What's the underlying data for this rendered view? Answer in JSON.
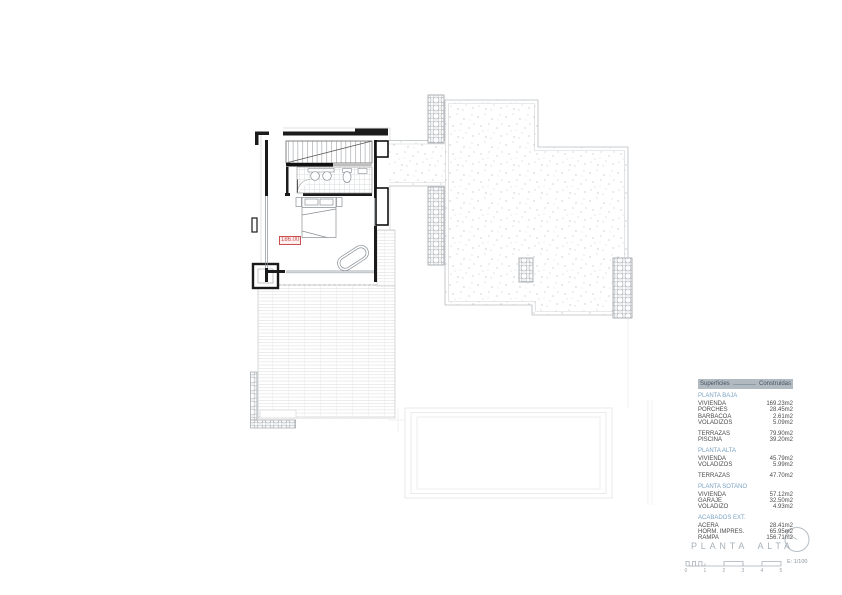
{
  "drawing": {
    "level_label": "186.00"
  },
  "areas_table": {
    "header": {
      "col1": "Superficies",
      "col2": "Construidas"
    },
    "sections": [
      {
        "title": "PLANTA BAJA",
        "groups": [
          [
            {
              "label": "VIVIENDA",
              "value": "169.23m2"
            },
            {
              "label": "PORCHES",
              "value": "28.45m2"
            },
            {
              "label": "BARBACOA",
              "value": "2.61m2"
            },
            {
              "label": "VOLADIZOS",
              "value": "5.09m2"
            }
          ],
          [
            {
              "label": "TERRAZAS",
              "value": "79.90m2"
            },
            {
              "label": "PISCINA",
              "value": "39.20m2"
            }
          ]
        ]
      },
      {
        "title": "PLANTA ALTA",
        "groups": [
          [
            {
              "label": "VIVIENDA",
              "value": "45.79m2"
            },
            {
              "label": "VOLADIZOS",
              "value": "5.99m2"
            }
          ],
          [
            {
              "label": "TERRAZAS",
              "value": "47.70m2"
            }
          ]
        ]
      },
      {
        "title": "PLANTA SOTANO",
        "groups": [
          [
            {
              "label": "VIVIENDA",
              "value": "57.12m2"
            },
            {
              "label": "GARAJE",
              "value": "32.50m2"
            },
            {
              "label": "VOLADIZO",
              "value": "4.93m2"
            }
          ]
        ]
      },
      {
        "title": "ACABADOS EXT.",
        "groups": [
          [
            {
              "label": "ACERA",
              "value": "28.41m2"
            },
            {
              "label": "HORM. IMPRES.",
              "value": "65.95m2"
            },
            {
              "label": "RAMPA",
              "value": "156.71m2"
            }
          ]
        ]
      }
    ]
  },
  "title_block": {
    "title": "PLANTA ALTA",
    "scale_text": "E: 1/100",
    "scale_ticks": [
      "0",
      "1",
      "2",
      "3",
      "4",
      "5"
    ]
  },
  "colors": {
    "table_header_bg": "#b2bac1",
    "table_header_text": "#44525f",
    "section_title": "#7ba3c2",
    "body_text": "#4b4b4b",
    "level_label_red": "#c94f4f",
    "title_gray": "#a7b1b9"
  }
}
